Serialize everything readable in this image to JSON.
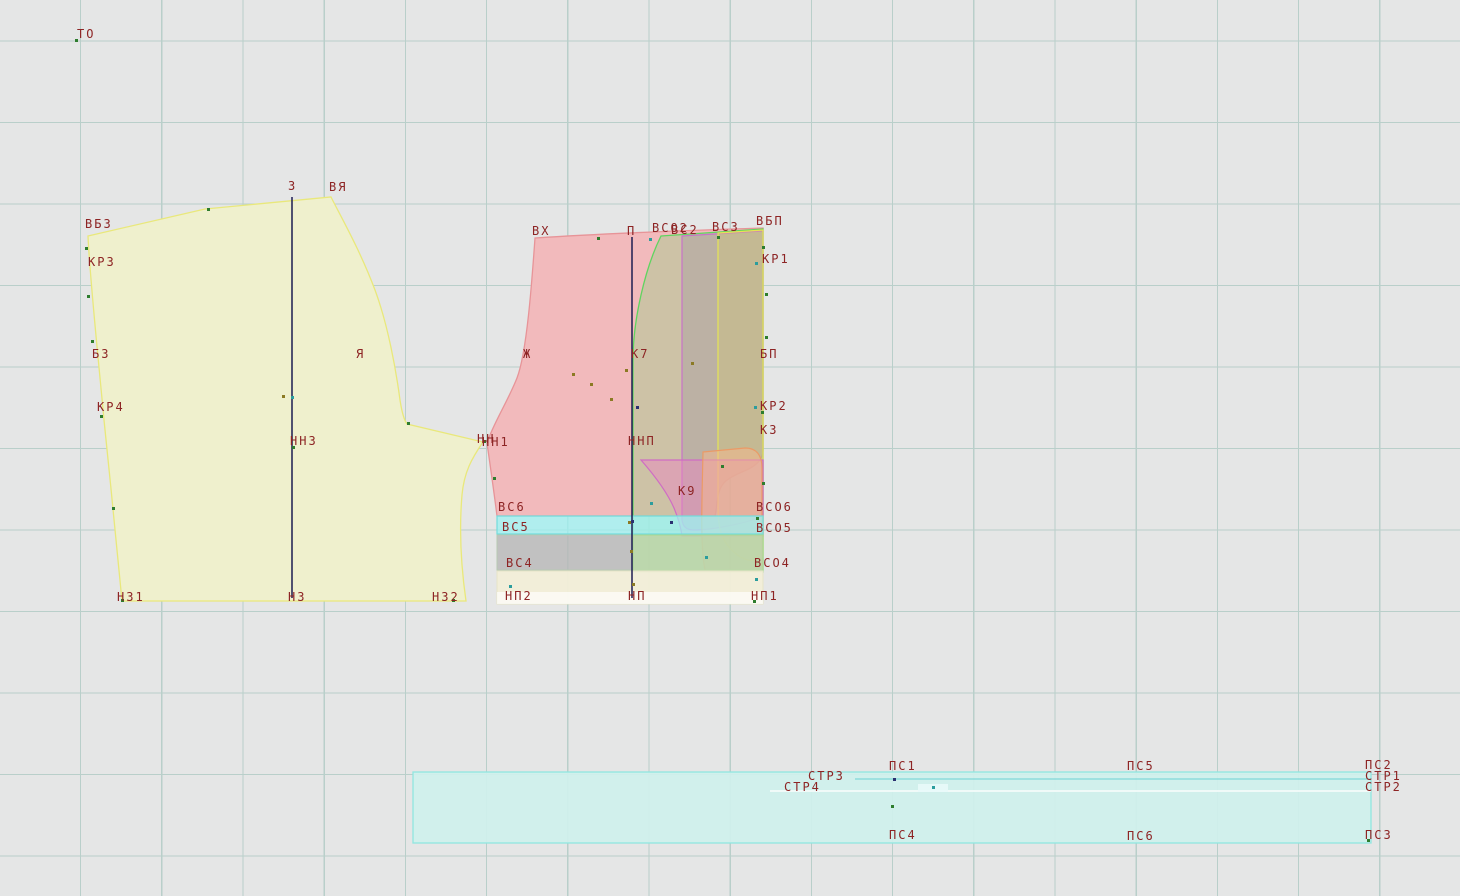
{
  "app": {
    "background_color": "#e5e6e6",
    "grid_color": "#b9cfca",
    "label_color": "#8d2424"
  },
  "colors": {
    "back_fill": "#eff0cd",
    "back_stroke": "#e9e87b",
    "front_fill": "#f2babc",
    "front_stroke": "#e79498",
    "green_fill": "rgba(130,214,120,0.33)",
    "green_stroke": "#5fd45f",
    "purple_fill": "rgba(150,140,158,0.30)",
    "purple_stroke": "#c873c8",
    "yellow_fill": "rgba(214,206,110,0.30)",
    "yellow_stroke": "#e6e455",
    "k9_fill": "rgba(238,130,195,0.45)",
    "k9_stroke": "#cf6cc4",
    "salmon_fill": "rgba(246,184,140,0.50)",
    "salmon_stroke": "#eb9a66",
    "cyan_fill": "rgba(158,240,240,0.75)",
    "cyan_stroke": "#72dcdc",
    "gray_fill": "rgba(184,184,184,0.80)",
    "gray_stroke": "#b7c9b2",
    "greenstrip_fill": "rgba(190,230,165,0.60)",
    "greenstrip_stroke": "#a8d890",
    "cream_fill": "rgba(242,238,216,0.95)",
    "cream_stroke": "#e6e4c8",
    "white_fill": "rgba(255,255,255,0.65)",
    "band_fill": "rgba(207,241,237,0.92)",
    "band_stroke": "#90e7e1",
    "line_navy": "#1c1c52",
    "point_green": "#2e7d2e",
    "point_olive": "#8b7a24",
    "point_teal": "#2b9d9d",
    "point_navy": "#2b3070"
  },
  "labels": [
    {
      "text": "ТО",
      "x": 77,
      "y": 28
    },
    {
      "text": "ВБЗ",
      "x": 85,
      "y": 218
    },
    {
      "text": "КР3",
      "x": 88,
      "y": 256
    },
    {
      "text": "З",
      "x": 288,
      "y": 180
    },
    {
      "text": "ВЯ",
      "x": 329,
      "y": 181
    },
    {
      "text": "БЗ",
      "x": 92,
      "y": 348
    },
    {
      "text": "Я",
      "x": 356,
      "y": 348
    },
    {
      "text": "КР4",
      "x": 97,
      "y": 401
    },
    {
      "text": "ННЗ",
      "x": 290,
      "y": 435
    },
    {
      "text": "НЗ1",
      "x": 117,
      "y": 591
    },
    {
      "text": "НЗ",
      "x": 288,
      "y": 591
    },
    {
      "text": "НЗ2",
      "x": 432,
      "y": 591
    },
    {
      "text": "ВХ",
      "x": 532,
      "y": 225
    },
    {
      "text": "П",
      "x": 627,
      "y": 225
    },
    {
      "text": "ВСО2",
      "x": 652,
      "y": 222
    },
    {
      "text": "ВС2",
      "x": 671,
      "y": 224
    },
    {
      "text": "ВС3",
      "x": 712,
      "y": 221
    },
    {
      "text": "ВБП",
      "x": 756,
      "y": 215
    },
    {
      "text": "КР1",
      "x": 762,
      "y": 253
    },
    {
      "text": "Ж",
      "x": 523,
      "y": 348
    },
    {
      "text": "К7",
      "x": 631,
      "y": 348
    },
    {
      "text": "БП",
      "x": 760,
      "y": 348
    },
    {
      "text": "КР2",
      "x": 760,
      "y": 400
    },
    {
      "text": "К3",
      "x": 760,
      "y": 424
    },
    {
      "text": "НН",
      "x": 477,
      "y": 433
    },
    {
      "text": "НН1",
      "x": 482,
      "y": 436
    },
    {
      "text": "ННП",
      "x": 628,
      "y": 435
    },
    {
      "text": "К9",
      "x": 678,
      "y": 485
    },
    {
      "text": "ВС6",
      "x": 498,
      "y": 501
    },
    {
      "text": "ВС5",
      "x": 502,
      "y": 521
    },
    {
      "text": "ВС4",
      "x": 506,
      "y": 557
    },
    {
      "text": "ВСО6",
      "x": 756,
      "y": 501
    },
    {
      "text": "ВСО5",
      "x": 756,
      "y": 522
    },
    {
      "text": "ВСО4",
      "x": 754,
      "y": 557
    },
    {
      "text": "НП2",
      "x": 505,
      "y": 590
    },
    {
      "text": "НП",
      "x": 628,
      "y": 590
    },
    {
      "text": "НП1",
      "x": 751,
      "y": 590
    },
    {
      "text": "СТР3",
      "x": 808,
      "y": 770
    },
    {
      "text": "СТР4",
      "x": 784,
      "y": 781
    },
    {
      "text": "ПС1",
      "x": 889,
      "y": 760
    },
    {
      "text": "ПС4",
      "x": 889,
      "y": 829
    },
    {
      "text": "ПС5",
      "x": 1127,
      "y": 760
    },
    {
      "text": "ПС6",
      "x": 1127,
      "y": 830
    },
    {
      "text": "ПС2",
      "x": 1365,
      "y": 759
    },
    {
      "text": "СТР1",
      "x": 1365,
      "y": 770
    },
    {
      "text": "СТР2",
      "x": 1365,
      "y": 781
    },
    {
      "text": "ПС3",
      "x": 1365,
      "y": 829
    }
  ],
  "points": [
    {
      "x": 76,
      "y": 40,
      "c": "green"
    },
    {
      "x": 208,
      "y": 209,
      "c": "green"
    },
    {
      "x": 86,
      "y": 248,
      "c": "green"
    },
    {
      "x": 88,
      "y": 296,
      "c": "green"
    },
    {
      "x": 92,
      "y": 341,
      "c": "green"
    },
    {
      "x": 101,
      "y": 416,
      "c": "green"
    },
    {
      "x": 113,
      "y": 508,
      "c": "green"
    },
    {
      "x": 122,
      "y": 600,
      "c": "green"
    },
    {
      "x": 283,
      "y": 396,
      "c": "olive"
    },
    {
      "x": 292,
      "y": 397,
      "c": "teal"
    },
    {
      "x": 293,
      "y": 447,
      "c": "green"
    },
    {
      "x": 408,
      "y": 423,
      "c": "green"
    },
    {
      "x": 453,
      "y": 600,
      "c": "green"
    },
    {
      "x": 484,
      "y": 441,
      "c": "green"
    },
    {
      "x": 494,
      "y": 478,
      "c": "green"
    },
    {
      "x": 598,
      "y": 238,
      "c": "green"
    },
    {
      "x": 650,
      "y": 239,
      "c": "teal"
    },
    {
      "x": 718,
      "y": 237,
      "c": "green"
    },
    {
      "x": 763,
      "y": 247,
      "c": "green"
    },
    {
      "x": 756,
      "y": 263,
      "c": "teal"
    },
    {
      "x": 766,
      "y": 294,
      "c": "green"
    },
    {
      "x": 766,
      "y": 337,
      "c": "green"
    },
    {
      "x": 573,
      "y": 374,
      "c": "olive"
    },
    {
      "x": 591,
      "y": 384,
      "c": "olive"
    },
    {
      "x": 611,
      "y": 399,
      "c": "olive"
    },
    {
      "x": 626,
      "y": 370,
      "c": "olive"
    },
    {
      "x": 692,
      "y": 363,
      "c": "olive"
    },
    {
      "x": 637,
      "y": 407,
      "c": "navy"
    },
    {
      "x": 755,
      "y": 407,
      "c": "teal"
    },
    {
      "x": 762,
      "y": 412,
      "c": "green"
    },
    {
      "x": 722,
      "y": 466,
      "c": "green"
    },
    {
      "x": 763,
      "y": 483,
      "c": "green"
    },
    {
      "x": 651,
      "y": 503,
      "c": "teal"
    },
    {
      "x": 629,
      "y": 522,
      "c": "olive"
    },
    {
      "x": 632,
      "y": 521,
      "c": "navy"
    },
    {
      "x": 671,
      "y": 522,
      "c": "navy"
    },
    {
      "x": 631,
      "y": 551,
      "c": "olive"
    },
    {
      "x": 706,
      "y": 557,
      "c": "teal"
    },
    {
      "x": 757,
      "y": 518,
      "c": "green"
    },
    {
      "x": 756,
      "y": 579,
      "c": "teal"
    },
    {
      "x": 510,
      "y": 586,
      "c": "teal"
    },
    {
      "x": 633,
      "y": 584,
      "c": "olive"
    },
    {
      "x": 754,
      "y": 601,
      "c": "green"
    },
    {
      "x": 894,
      "y": 779,
      "c": "navy"
    },
    {
      "x": 933,
      "y": 787,
      "c": "teal"
    },
    {
      "x": 892,
      "y": 806,
      "c": "green"
    },
    {
      "x": 1368,
      "y": 840,
      "c": "green"
    }
  ]
}
